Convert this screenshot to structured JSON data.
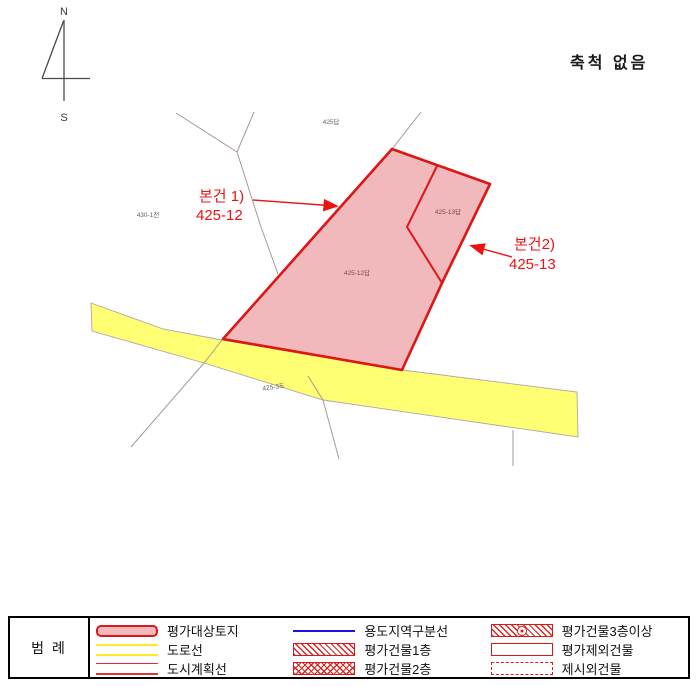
{
  "scale_label": "축척 없음",
  "compass": {
    "north": "N",
    "south": "S"
  },
  "map": {
    "subject_annotations": [
      {
        "name": "본건 1)",
        "parcel": "425-12"
      },
      {
        "name": "본건2)",
        "parcel": "425-13"
      }
    ],
    "parcel_labels": {
      "north_parcel": "425답",
      "west_parcel": "430-1전",
      "subject1": "425-12답",
      "subject2": "425-13답",
      "road": "425-3도"
    },
    "colors": {
      "subject_fill": "#f2b9bd",
      "subject_border": "#dd1616",
      "road_fill": "#ffff73",
      "annotation_red": "#ee1111",
      "boundary_line": "#a89898"
    }
  },
  "legend": {
    "title": "범  례",
    "items": [
      {
        "symbol": "subject-parcel",
        "label": "평가대상토지"
      },
      {
        "symbol": "road-line",
        "label": "도로선"
      },
      {
        "symbol": "city-plan-line",
        "label": "도시계획선"
      },
      {
        "symbol": "zoning-line",
        "label": "용도지역구분선"
      },
      {
        "symbol": "building-1f",
        "label": "평가건물1층"
      },
      {
        "symbol": "building-2f",
        "label": "평가건물2층"
      },
      {
        "symbol": "building-3f",
        "label": "평가건물3층이상"
      },
      {
        "symbol": "excluded-building",
        "label": "평가제외건물"
      },
      {
        "symbol": "unlisted-building",
        "label": "제시외건물"
      }
    ]
  }
}
